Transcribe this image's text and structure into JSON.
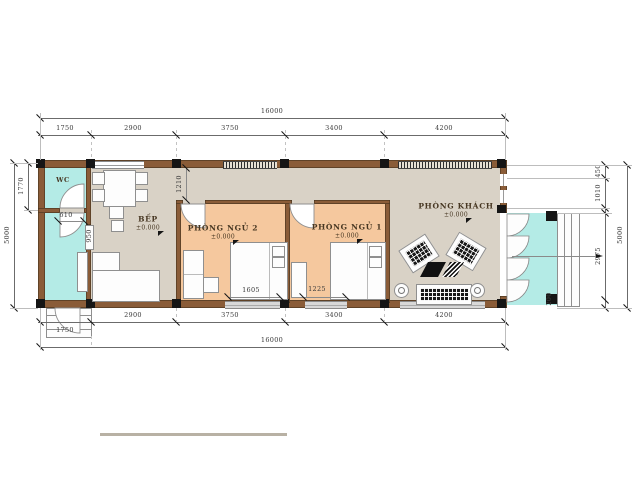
{
  "title": "house-floor-plan",
  "rooms": {
    "wc": {
      "label": "WC"
    },
    "kitchen": {
      "label": "BẾP",
      "elevation": "±0.000"
    },
    "bedroom2": {
      "label": "PHÒNG NGỦ 2",
      "elevation": "±0.000"
    },
    "bedroom1": {
      "label": "PHÒNG NGỦ 1",
      "elevation": "±0.000"
    },
    "living": {
      "label": "PHÒNG KHÁCH",
      "elevation": "±0.000"
    }
  },
  "dims": {
    "top_total": "16000",
    "top_segments": [
      "1750",
      "2900",
      "3750",
      "3400",
      "4200"
    ],
    "bottom_segments": [
      "1750",
      "2900",
      "3750",
      "3400",
      "4200"
    ],
    "bottom_total": "16000",
    "left": {
      "wc_height": "1770",
      "overall": "5000"
    },
    "right": {
      "seg1": "450",
      "seg2": "1010",
      "seg3": "2975",
      "porch_edge": "200",
      "overall": "5000"
    },
    "interior": {
      "corridor_width": "1210",
      "wc_door": "610",
      "pass_opening": "950",
      "bedroom2_window": "1605",
      "bedroom1_window": "1225"
    }
  },
  "colors": {
    "floor": "#d9d2c6",
    "bedroom_floor": "#f5c89e",
    "wet_floor": "#b4ebe6",
    "wall": "#8a5c38",
    "column": "#151515",
    "dimension": "#3a3a3a"
  }
}
